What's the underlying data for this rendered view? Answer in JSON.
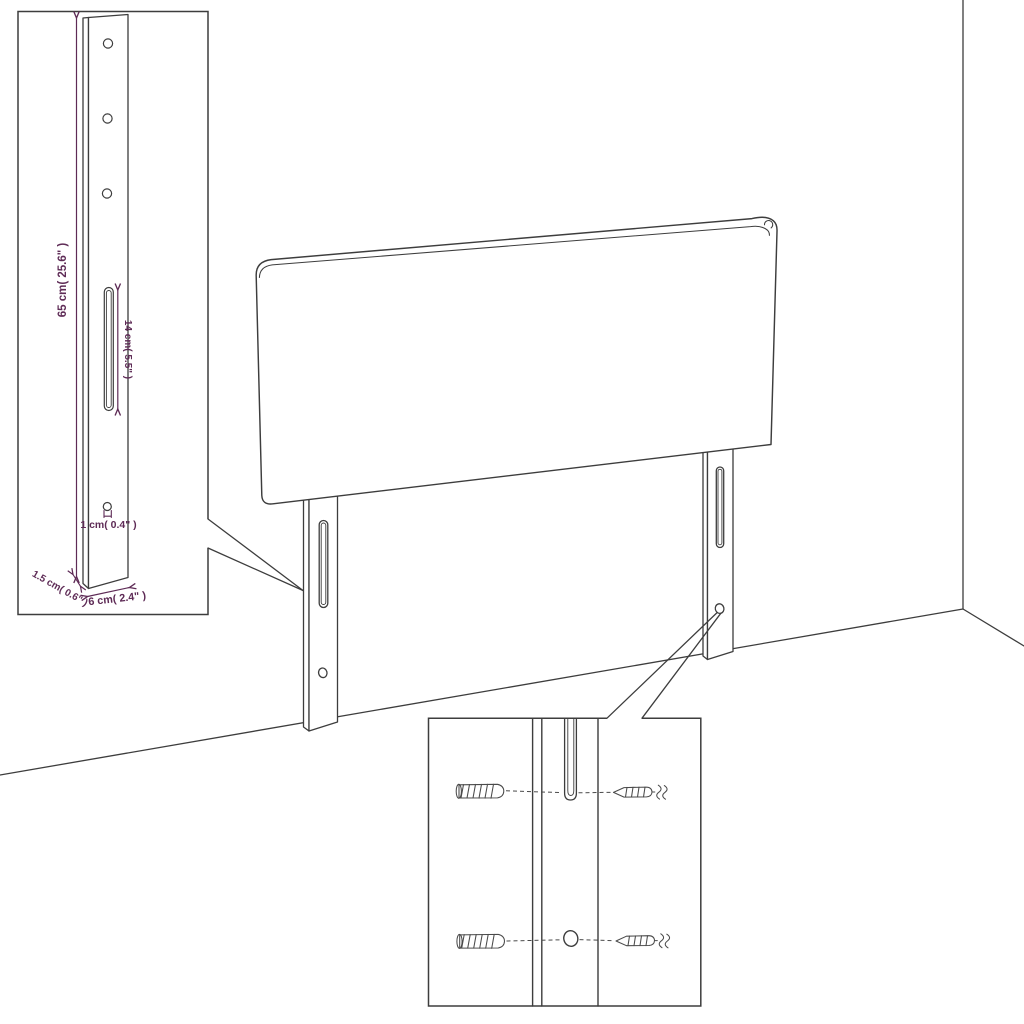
{
  "diagram": {
    "colors": {
      "ink": "#3d3d3d",
      "accent": "#5e2b56",
      "background": "#ffffff"
    },
    "leg_detail": {
      "dimensions": {
        "height": "65 cm( 25.6\" )",
        "slot_length": "14 cm( 5.5\" )",
        "hole_width": "1 cm( 0.4\" )",
        "thickness": "1.5 cm( 0.6\" )",
        "width": "6 cm( 2.4\" )"
      }
    },
    "hardware_detail": {
      "items": [
        "wall-plug",
        "screw",
        "wall-plug",
        "screw"
      ]
    },
    "parts": [
      "headboard-panel",
      "left-leg",
      "right-leg"
    ]
  }
}
